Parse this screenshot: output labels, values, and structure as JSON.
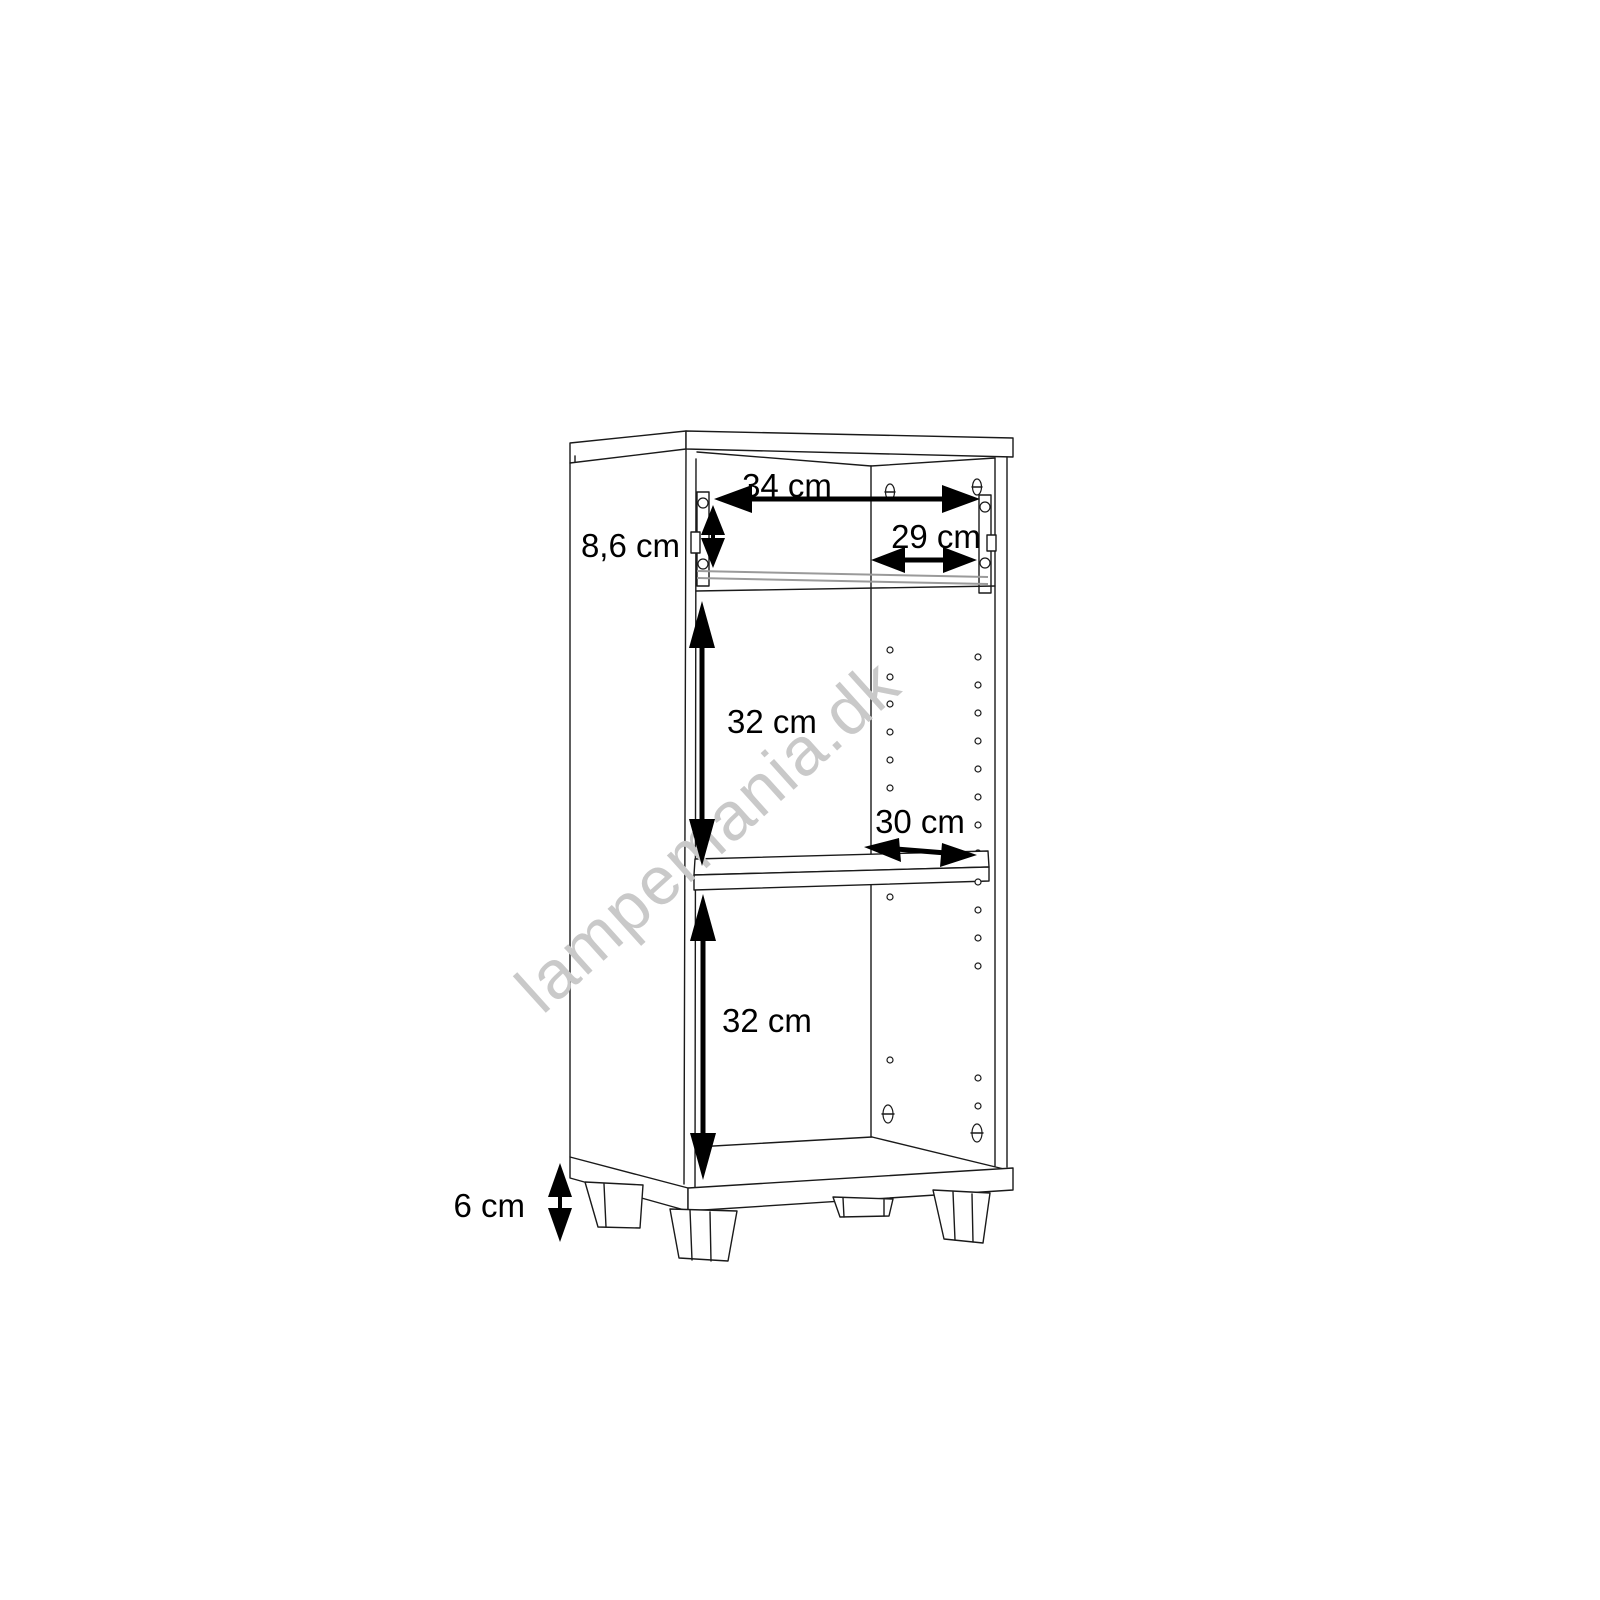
{
  "page": {
    "background": "#ffffff"
  },
  "watermark": {
    "text": "lampemania.dk",
    "color": "#c9c9c9"
  },
  "diagram": {
    "subject": "cabinet-dimension-drawing",
    "colors": {
      "line": "#1a1a1a",
      "gray_line": "#9a9a9a",
      "text": "#000000"
    },
    "dimensions": {
      "top_width": {
        "label": "34 cm"
      },
      "drawer_height": {
        "label": "8,6 cm"
      },
      "drawer_inner_width": {
        "label": "29 cm"
      },
      "upper_section_height": {
        "label": "32 cm"
      },
      "shelf_depth": {
        "label": "30 cm"
      },
      "lower_section_height": {
        "label": "32 cm"
      },
      "feet_height": {
        "label": "6 cm"
      }
    }
  }
}
